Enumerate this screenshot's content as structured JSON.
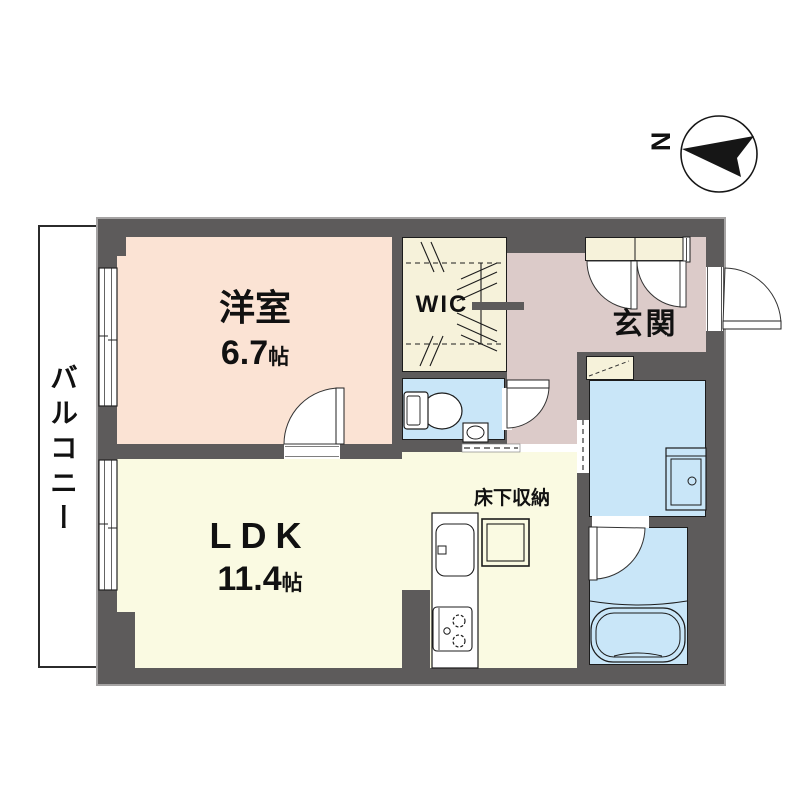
{
  "compass": {
    "north_label": "N"
  },
  "rooms": {
    "balcony": {
      "label": "バルコニー"
    },
    "western_room": {
      "label": "洋室",
      "size": "6.7",
      "unit": "帖"
    },
    "ldk": {
      "label": "LDK",
      "size": "11.4",
      "unit": "帖"
    },
    "wic": {
      "label": "WIC"
    },
    "entrance": {
      "label": "玄関"
    },
    "underfloor_storage": {
      "label": "床下収納"
    }
  },
  "fixtures": {
    "toilet": "toilet-icon",
    "hand_basin": "washbasin-icon",
    "vanity": "vanity-icon",
    "bathtub": "bathtub-icon",
    "kitchen_sink": "kitchen-sink-icon",
    "stove": "stove-icon",
    "shoe_cabinet": "shoe-cabinet-icon",
    "underfloor_storage_hatch": "underfloor-storage-icon",
    "sliding_window": "window-icon",
    "hinged_door": "door-swing-icon",
    "sliding_door": "sliding-door-icon",
    "compass": "compass-north-icon"
  },
  "colors": {
    "wall": "#5d5b5b",
    "peach": "#fbe3d4",
    "cream": "#f6f2da",
    "yellow": "#fafae2",
    "mauve": "#dccbc9",
    "blue": "#c9e6f8",
    "line": "#1c1c1c",
    "outline": "#a5a3a3"
  }
}
